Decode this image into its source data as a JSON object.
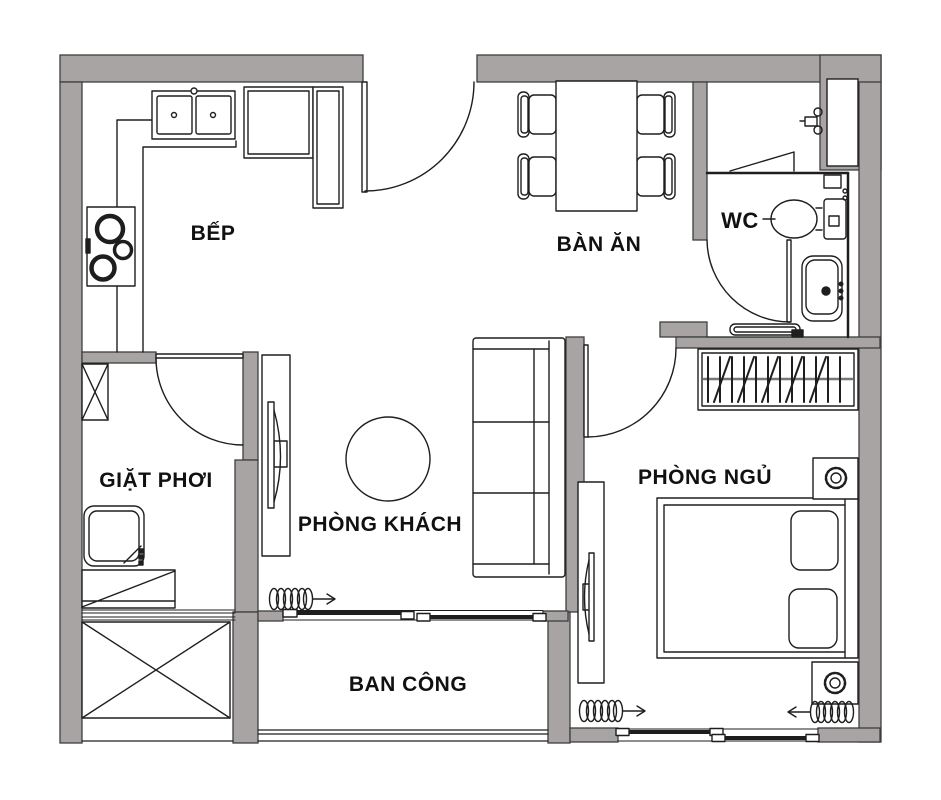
{
  "document": {
    "type": "apartment-floor-plan"
  },
  "colors": {
    "wall": "#a8a4a4",
    "wall_edge": "#3e3e3e",
    "line": "#1e1e1e",
    "text": "#111111",
    "background": "#ffffff"
  },
  "rooms": {
    "kitchen": {
      "label": "BẾP"
    },
    "dining": {
      "label": "BÀN ĂN"
    },
    "wc": {
      "label": "WC"
    },
    "laundry": {
      "label": "GIẶT PHƠI"
    },
    "living": {
      "label": "PHÒNG KHÁCH"
    },
    "bedroom": {
      "label": "PHÒNG NGỦ"
    },
    "balcony": {
      "label": "BAN CÔNG"
    }
  },
  "icons": [
    "kitchen-sink-icon",
    "cooktop-icon",
    "fridge-icon",
    "tall-cabinet-icon",
    "entrance-door-icon",
    "dining-table-icon",
    "dining-chair-icon",
    "toilet-icon",
    "lavabo-icon",
    "shower-faucet-icon",
    "wc-door-icon",
    "towel-bar-icon",
    "wardrobe-icon",
    "bed-icon",
    "pillow-icon",
    "nightstand-lamp-icon",
    "bedroom-door-icon",
    "tv-cabinet-icon",
    "sofa-icon",
    "round-rug-icon",
    "laundry-door-icon",
    "washing-machine-icon",
    "drying-rack-icon",
    "utility-ledge-icon",
    "sliding-door-icon",
    "curtain-coil-icon",
    "balcony-railing-icon"
  ]
}
